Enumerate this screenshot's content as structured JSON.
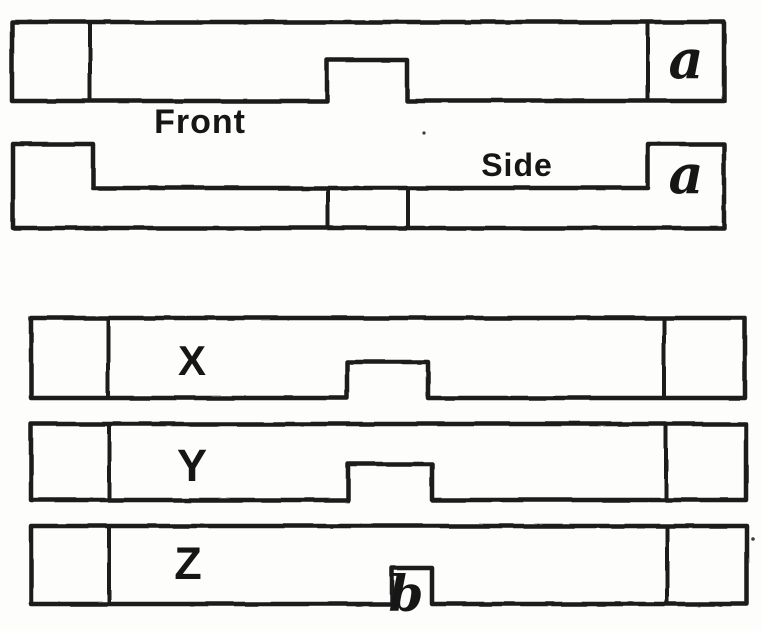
{
  "canvas": {
    "paper_color": "#fdfdfb",
    "ink_color": "#1c1c1c"
  },
  "figure": {
    "front_view": {
      "caption": "Front",
      "end_block_label": "a"
    },
    "side_view": {
      "caption": "Side",
      "end_block_label": "a"
    },
    "options": [
      {
        "label": "X"
      },
      {
        "label": "Y"
      },
      {
        "label": "Z",
        "notch_label": "b"
      }
    ]
  }
}
